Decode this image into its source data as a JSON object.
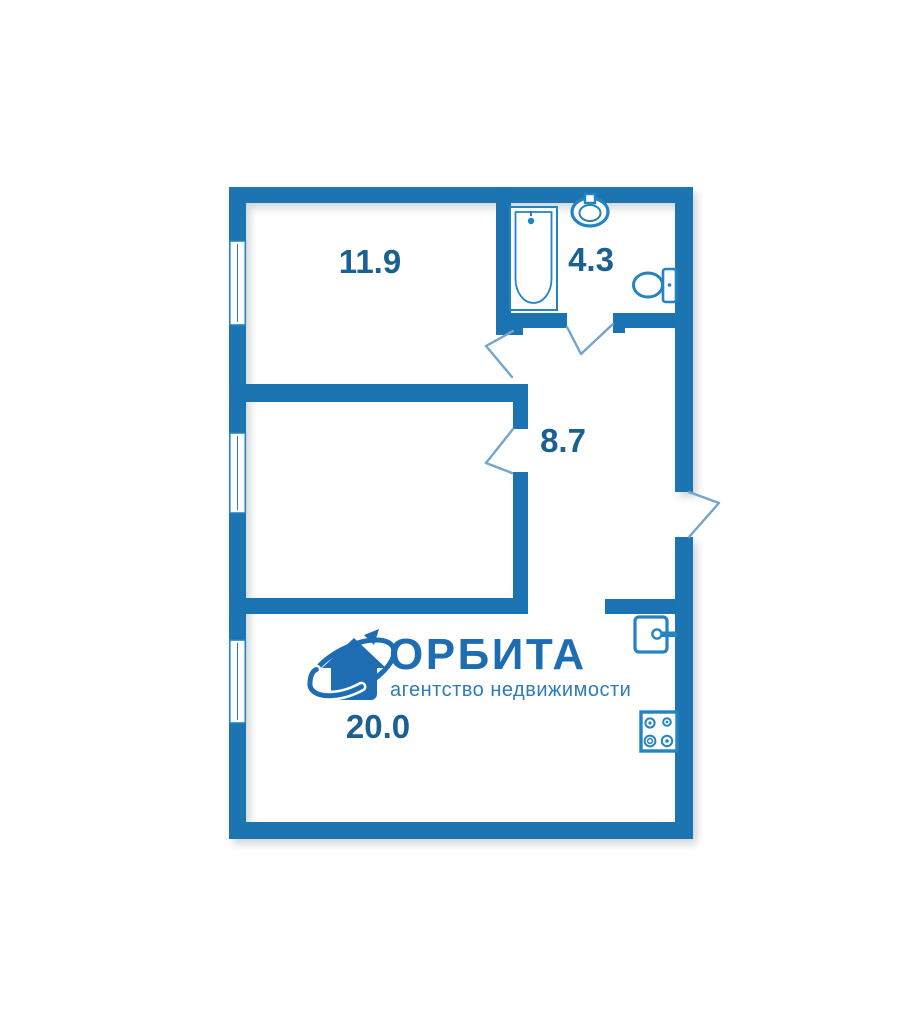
{
  "brand": {
    "name": "ОРБИТА",
    "tagline": "агентство недвижимости"
  },
  "rooms": [
    {
      "id": "bedroom-top",
      "area": "11.9"
    },
    {
      "id": "bathroom",
      "area": "4.3"
    },
    {
      "id": "hallway",
      "area": "8.7"
    },
    {
      "id": "living-kitchen",
      "area": "20.0"
    }
  ],
  "icons": [
    "bathtub-icon",
    "washbasin-icon",
    "toilet-icon",
    "kitchen-sink-icon",
    "stove-icon",
    "house-orbit-logo-icon"
  ],
  "colors": {
    "wall": "#1b74b1",
    "label": "#1a6091",
    "logo": "#1e6cb2",
    "logo_sub": "#2e7cb8",
    "fixture": "#2483c1",
    "door_line": "#73a5cd"
  }
}
